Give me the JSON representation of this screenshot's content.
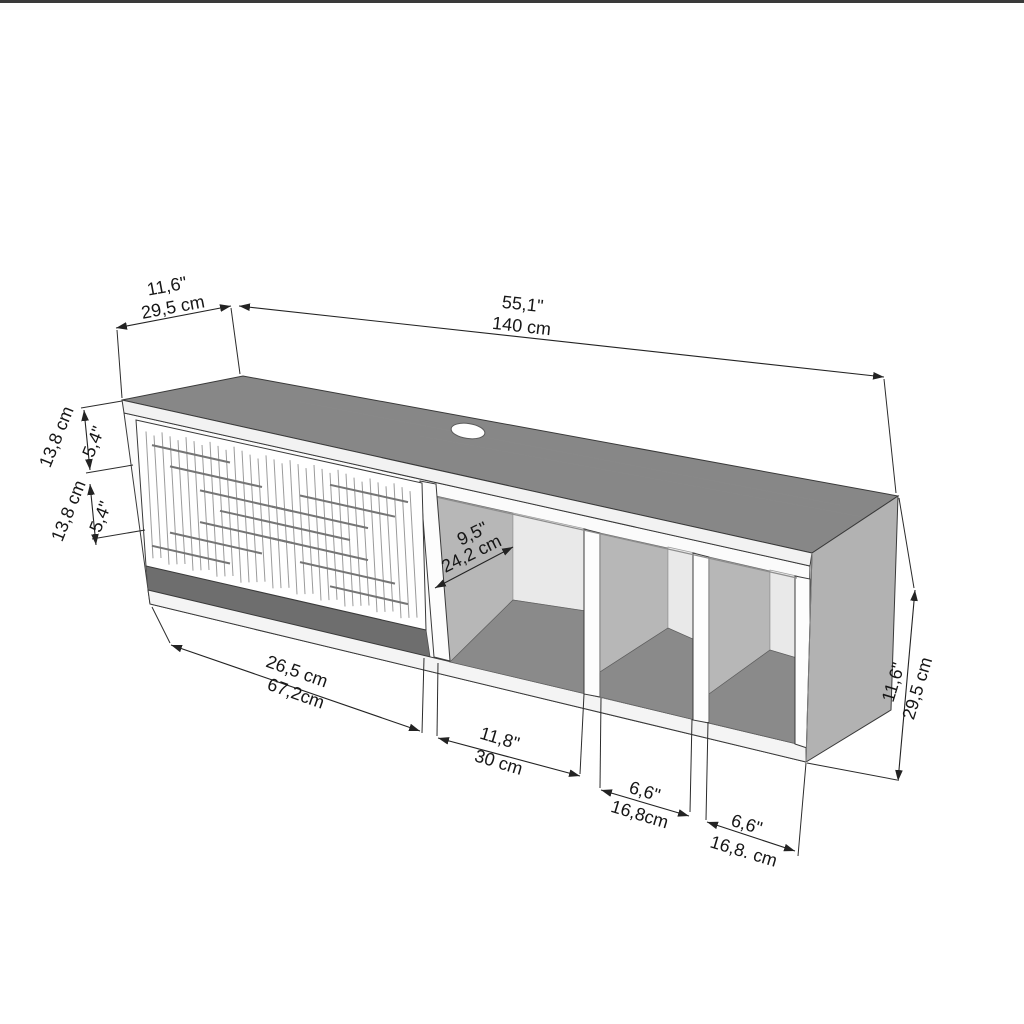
{
  "figure": {
    "title": "Wall-mounted TV stand dimensional drawing",
    "style": "isometric technical line drawing with dual-unit dimensions",
    "units": [
      "inches",
      "centimeters"
    ]
  },
  "labels": {
    "top_depth": {
      "line1": "11,6\"",
      "line2": "29,5 cm"
    },
    "top_width": {
      "line1": "55,1\"",
      "line2": "140 cm"
    },
    "left_upper": {
      "inner": "5,4\"",
      "outer": "13,8 cm"
    },
    "left_lower": {
      "inner": "5,4\"",
      "outer": "13,8 cm"
    },
    "shelf_depth": {
      "line1": "9,5\"",
      "line2": "24,2 cm"
    },
    "bottom_door": {
      "line1": "26,5 cm",
      "line2": "67,2cm"
    },
    "bottom_middle": {
      "line1": "11,8\"",
      "line2": "30 cm"
    },
    "bottom_shelf2": {
      "line1": "6,6\"",
      "line2": "16,8cm"
    },
    "bottom_shelf3": {
      "line1": "6,6\"",
      "line2": "16,8. cm"
    },
    "right_height": {
      "line1": "11,6\"",
      "line2": "29,5 cm"
    }
  },
  "colors": {
    "background": "#ffffff",
    "top_surface": "#878787",
    "right_side_panel": "#b2b2b2",
    "inner_side_wall": "#b7b7b7",
    "back_panel": "#e9e9e9",
    "shelf_floor": "#8a8a8a",
    "shadow_band": "#6e6e6e",
    "panel_edge": "#f2f2f2",
    "line": "#232323"
  }
}
